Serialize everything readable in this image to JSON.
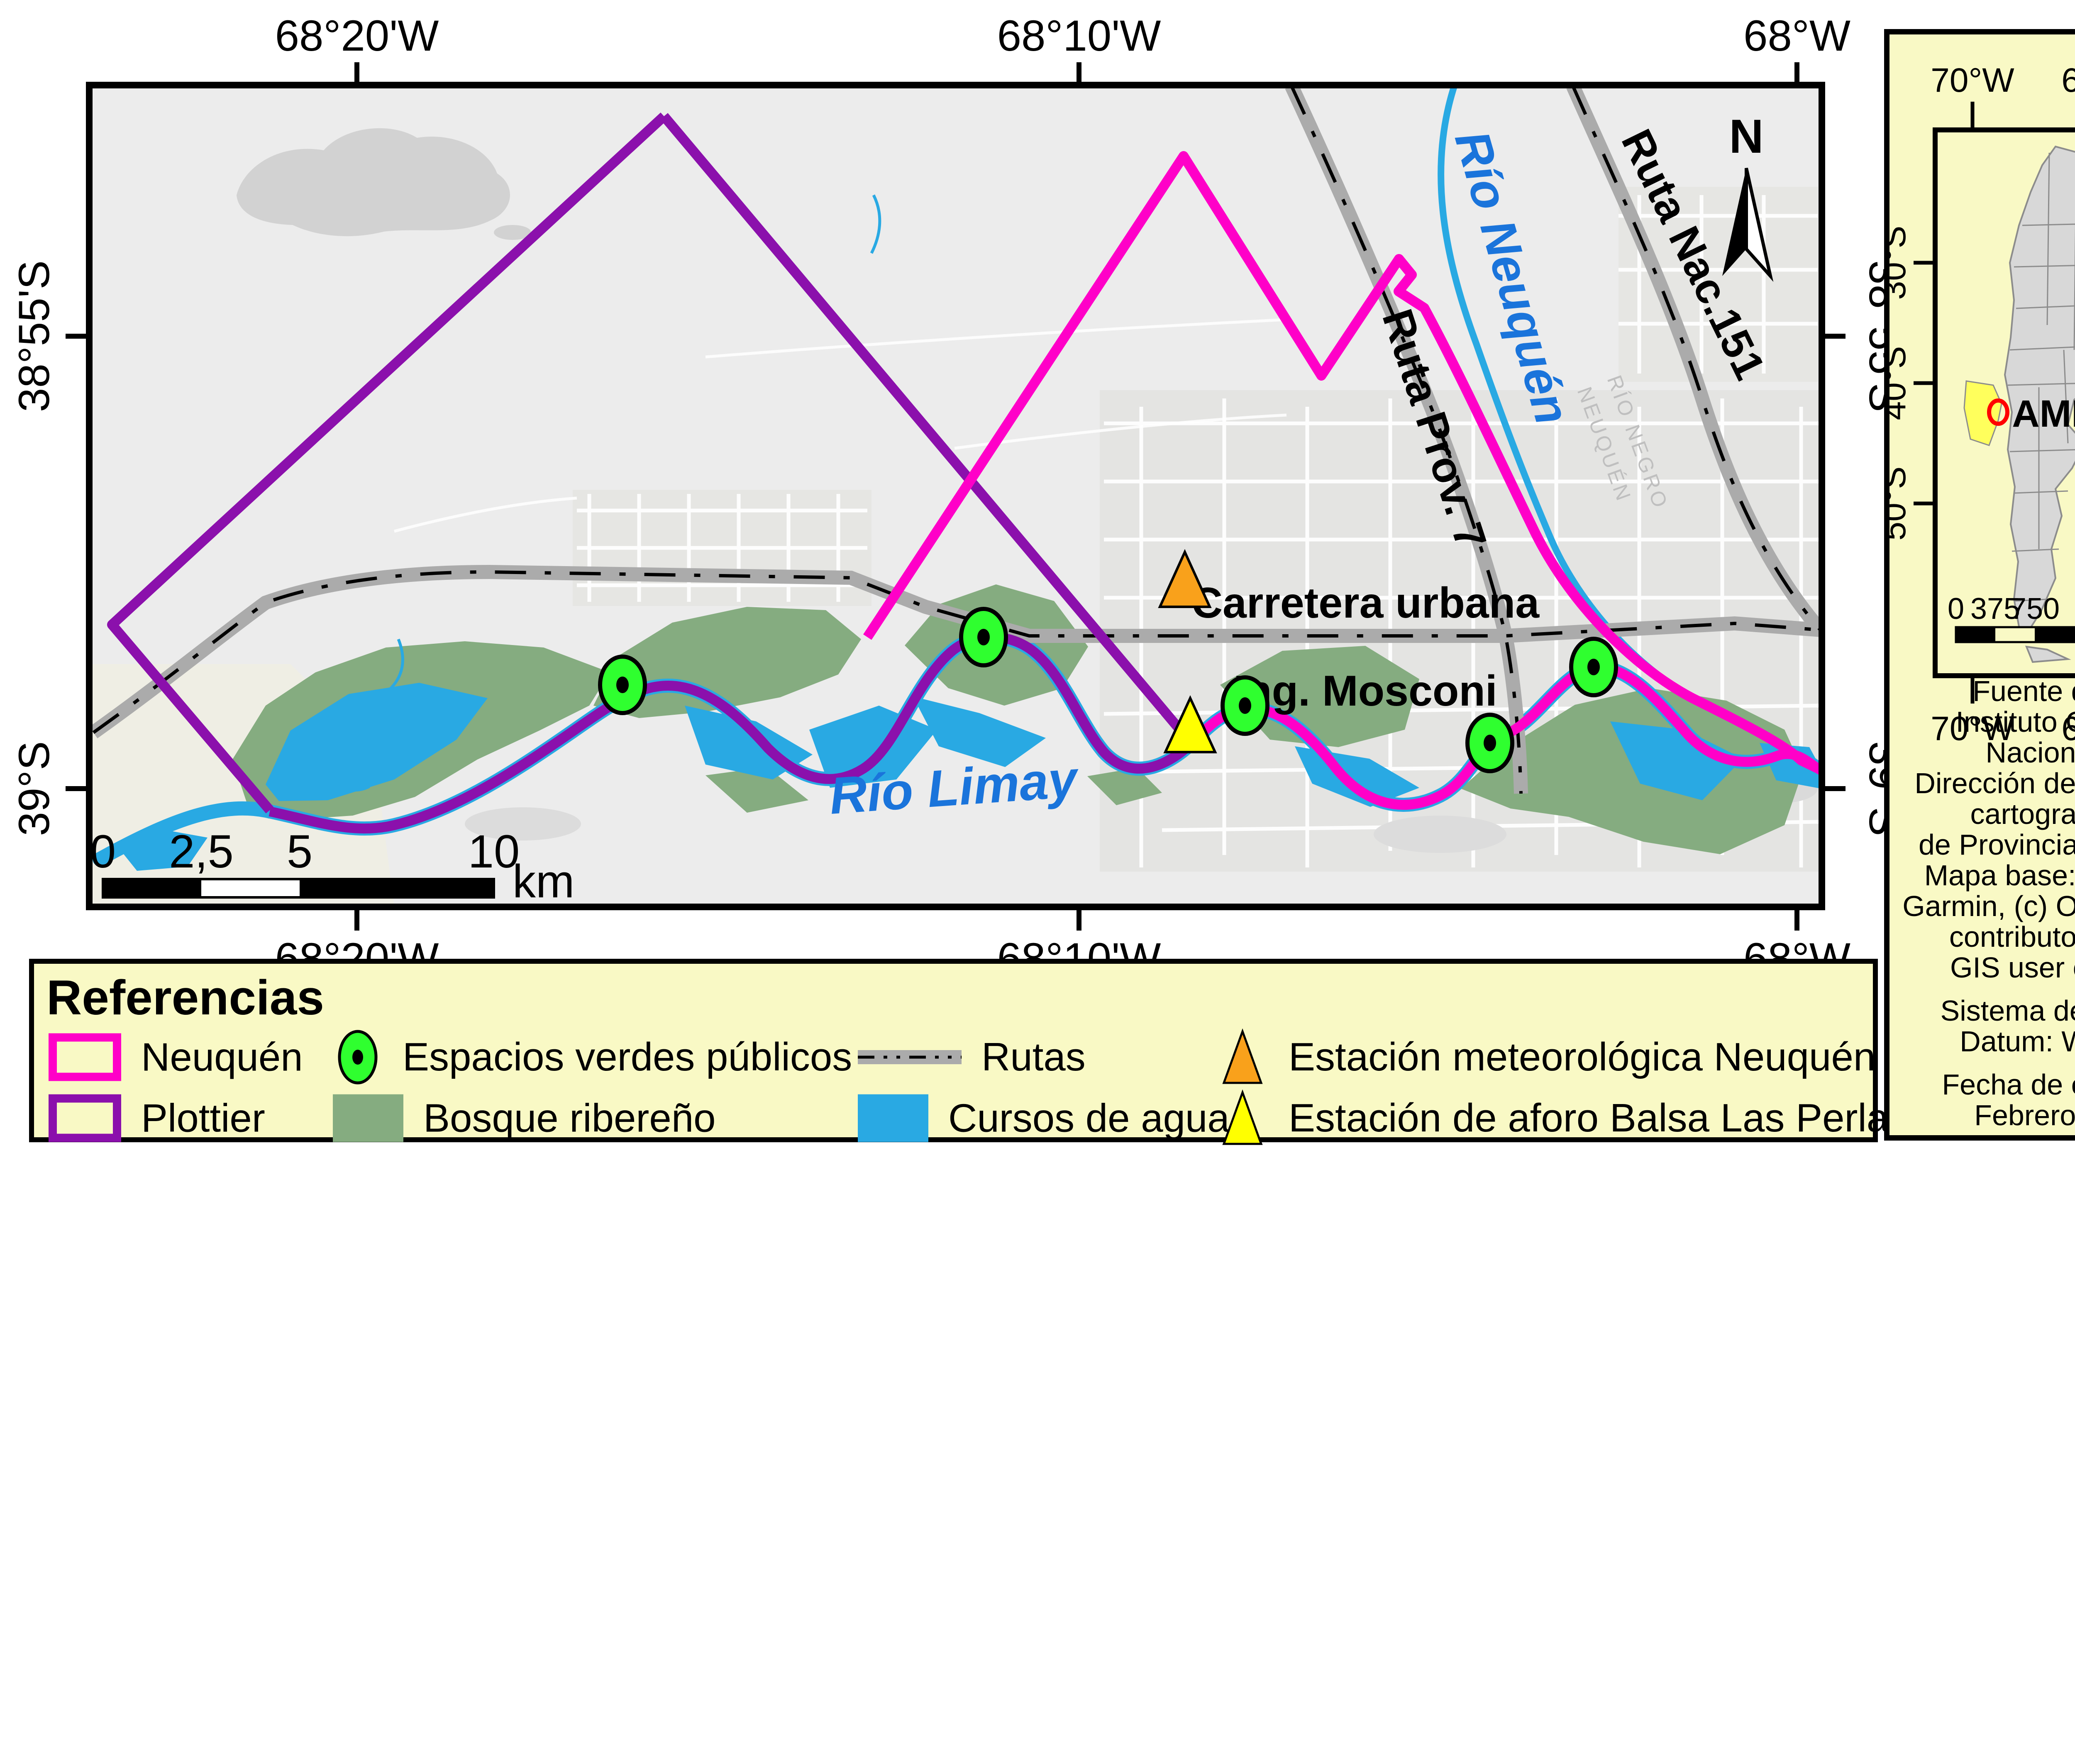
{
  "map": {
    "x_ticks": [
      "68°20'W",
      "68°10'W",
      "68°W"
    ],
    "y_ticks": [
      "38°55'S",
      "39°S"
    ],
    "labels": {
      "rio_neuquen": "Río Neuquén",
      "rio_limay": "Río Limay",
      "ruta_nac": "Ruta Nac.151",
      "ruta_prov": "Ruta Prov. 7",
      "carretera_1": "Carretera urbana",
      "carretera_2": "Ing. Mosconi",
      "border_faint_1": "RÍO NEGRO",
      "border_faint_2": "NEUQUÉN",
      "north": "N"
    },
    "scalebar": {
      "t0": "0",
      "t1": "2,5",
      "t2": "5",
      "t3": "10",
      "unit": "km"
    }
  },
  "legend": {
    "title": "Referencias",
    "items": [
      {
        "label": "Neuquén"
      },
      {
        "label": "Plottier"
      },
      {
        "label": "Espacios verdes públicos"
      },
      {
        "label": "Bosque ribereño"
      },
      {
        "label": "Rutas"
      },
      {
        "label": "Cursos de agua"
      },
      {
        "label": "Estación meteorológica Neuquén Aero"
      },
      {
        "label": "Estación de aforo Balsa Las Perlas"
      }
    ]
  },
  "inset": {
    "x_ticks": [
      "70°W",
      "60°W"
    ],
    "y_ticks": [
      "30°S",
      "40°S",
      "50°S"
    ],
    "region_label": "AMN",
    "north": "N",
    "scalebar": {
      "t0": "0",
      "t1": "375",
      "t2": "750",
      "t3": "1.500",
      "unit": "km"
    }
  },
  "panel": {
    "source_lines": [
      "Fuente de datos:",
      "Instituto Geográfico",
      "Nacional (IGN)",
      "Dirección de informática y",
      "cartografía digital",
      "de Provincia de Neuquén",
      "Mapa base: Esri, HERE,",
      "Garmin, (c) OpenStreetMap",
      "contributors, and the",
      "GIS user community"
    ],
    "reference_lines": [
      "Sistema de referencia",
      "Datum: WGS 1984"
    ],
    "date_lines": [
      "Fecha de elaboración",
      "Febrero de 2021"
    ]
  },
  "colors": {
    "neuquen_boundary": "#FF00C8",
    "plottier_boundary": "#8B10AC",
    "water": "#29A9E3",
    "forest": "#85AC80",
    "green_marker": "#2FFF2F",
    "orange_marker": "#F9A11B",
    "yellow_marker": "#FFFF00",
    "road": "#ABABAB",
    "panel_background": "#F9F9C5",
    "map_background": "#ECECEC"
  }
}
